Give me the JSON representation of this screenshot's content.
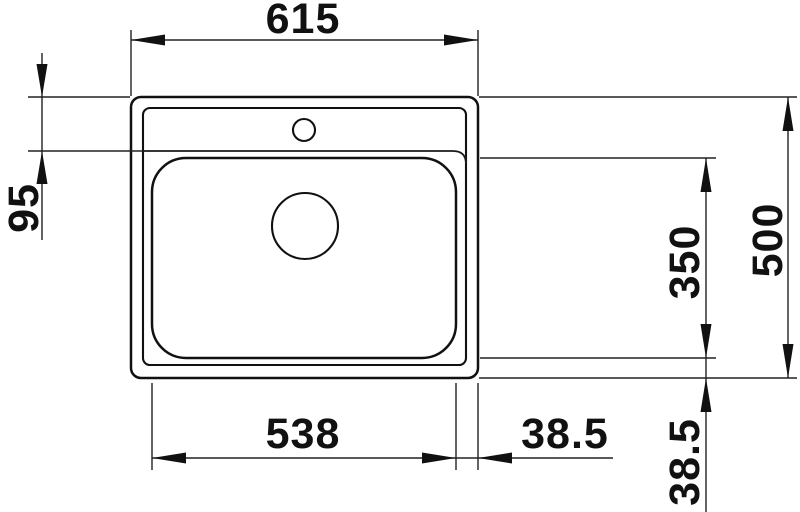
{
  "drawing": {
    "type": "sink-plan-view-dimension-drawing",
    "background_color": "#ffffff",
    "line_color": "#111111"
  },
  "labels": {
    "overall_width": "615",
    "deck_depth": "95",
    "bowl_width": "538",
    "bowl_depth": "350",
    "overall_depth": "500",
    "rim_offset_right": "38.5",
    "rim_offset_bottom": "38.5"
  }
}
